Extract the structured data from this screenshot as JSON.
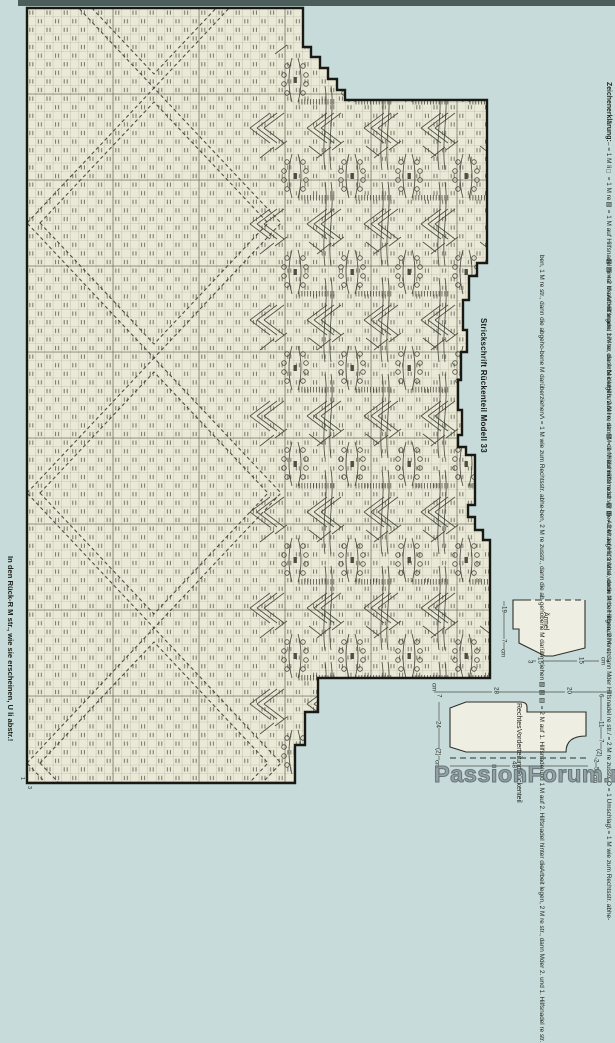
{
  "colors": {
    "page_bg": "#c7dcda",
    "top_band": "#4d5d59",
    "chart_bg": "#eae8d6",
    "grid_thin": "#a0a48f",
    "grid_major": "#656a58",
    "border": "#181815",
    "symbol": "#3c4035",
    "schematic_fill": "#efeee2"
  },
  "legend": {
    "heading": "Zeichenerklärung:",
    "col1_lines": [
      "Zeichenerklärung:",
      "– = 1 M li",
      "□ = 1 M re",
      "▨ = 1 M auf Hilfsnadel hinter die",
      "Arbeit legen, 1 M re, dann M der",
      "Hilfsnadel re str.",
      "▧ = 1 M auf Hilfsnadel vor die",
      "Arbeit legen, 1 M re, dann M der",
      "Hilfsnadel re str."
    ],
    "col2_lines": [
      "▨▨ = 2 M auf Hilfsnadel hin-",
      "ter die Arbeit legen, 2 M re, dann",
      "M der Hilfsnadel re str.",
      "▧▧ = 2 M auf Hilfsnadel vor",
      "die Arbeit legen, 2 M re, dann M",
      "der Hilfsnadel re str.",
      "/ = 2 M re zusstr.",
      "O = 1 Umschlag",
      "\\ = 1 M wie zum Rechtsstr. abhe-"
    ],
    "col3_lines": [
      "ben, 1 M re str., dann die abgeho-",
      "bene M darüberziehen",
      "Λ = 1 M wie zum Rechtsstr. abhe-",
      "ben, 2 M re zusstr., dann die ab-",
      "gehobene M darüberziehen",
      "▨▨▥ = 2 M auf 1. Hilfsnadel",
      "und 1 M auf 2. Hilfsnadel hinter die",
      "Arbeit legen, 2 M re str., dann M",
      "der 2. und 1. Hilfsnadel re str."
    ]
  },
  "chart_title": "Strickschrift Rückenteil Modell 33",
  "footnote": "In den Rück-R M str., wie sie erscheinen, U li abstr.!",
  "corner_marks": [
    {
      "t": "1",
      "x": 19,
      "y": 777
    },
    {
      "t": "3",
      "x": 26,
      "y": 786
    }
  ],
  "watermark": "PassionForum.ru",
  "chart": {
    "cell": 8.6,
    "outline": "M27,8 L303,8 L303,47 L311,47 L311,57 L320,57 L320,68 L328,68 L328,79 L337,79 L337,90 L345,90 L345,100 L487,100 L487,263 L477,263 L477,276 L469,276 L469,300 L463,300 L463,330 L467,330 L467,352 L461,352 L461,380 L458,380 L458,410 L462,410 L462,435 L458,435 L458,447 L466,447 L466,455 L475,455 L475,505 L468,505 L468,517 L475,517 L475,530 L483,530 L483,540 L490,540 L490,678 L318,678 L318,712 L305,712 L305,745 L295,745 L295,783 L27,783 Z",
    "bbox": [
      27,
      8,
      463,
      775
    ],
    "major_xs": [
      113,
      199,
      285,
      371,
      457
    ],
    "major_ys": [
      94,
      180,
      266,
      352,
      438,
      524,
      610,
      696,
      782
    ],
    "diamond_center_x": 154,
    "diamond_center_ys": [
      -47,
      223,
      493,
      763
    ],
    "diamond_rx": 127,
    "diamond_ry": 135,
    "cluster_xs": [
      295,
      352,
      409,
      466
    ],
    "cluster_ys": [
      80,
      176,
      272,
      368,
      464,
      560,
      656,
      752
    ]
  },
  "schematics": {
    "sleeve": {
      "label": "Ärmel",
      "solid_path": "M525,600 L513,600 L513,629 L519,629 L519,643 L545,656 L553,656 L585,648 L585,600",
      "dashed_path": "M525,600 L585,600",
      "dim_lines": [
        [
          504,
          601,
          504,
          655
        ],
        [
          528,
          661,
          609,
          661
        ]
      ],
      "measurements": [
        {
          "t": "19",
          "x": 500,
          "y": 606
        },
        {
          "t": "7",
          "x": 500,
          "y": 639
        },
        {
          "t": "cm",
          "x": 499,
          "y": 649
        },
        {
          "t": "3",
          "x": 526,
          "y": 660
        },
        {
          "t": "15",
          "x": 536,
          "y": 657
        },
        {
          "t": "15",
          "x": 577,
          "y": 657
        },
        {
          "t": "cm",
          "x": 599,
          "y": 657
        }
      ]
    },
    "body": {
      "label_lines": [
        "Rechtes",
        "Vorderteil",
        "und",
        "Rückenteil"
      ],
      "solid_path": "M450,708 L466,702 L520,702 Q527,702 527,707 L527,712 L586,712 L586,736 Q566,736 566,752 L466,752 L450,747 Z",
      "dashed_path": "M450,758 L588,758",
      "dim_lines": [
        [
          434,
          692,
          612,
          692
        ],
        [
          439,
          702,
          439,
          777
        ],
        [
          601,
          695,
          601,
          756
        ],
        [
          450,
          766,
          588,
          766
        ],
        [
          596,
          756,
          596,
          780
        ]
      ],
      "measurements": [
        {
          "t": "cm",
          "x": 430,
          "y": 683
        },
        {
          "t": "7",
          "x": 435,
          "y": 694
        },
        {
          "t": "28",
          "x": 492,
          "y": 687
        },
        {
          "t": "20",
          "x": 565,
          "y": 687
        },
        {
          "t": "6",
          "x": 597,
          "y": 694
        },
        {
          "t": "11",
          "x": 597,
          "y": 721
        },
        {
          "t": "7",
          "x": 597,
          "y": 739
        },
        {
          "t": "(2)",
          "x": 595,
          "y": 749
        },
        {
          "t": "2",
          "x": 592,
          "y": 759
        },
        {
          "t": "5",
          "x": 592,
          "y": 767
        },
        {
          "t": "cm",
          "x": 591,
          "y": 775
        },
        {
          "t": "24",
          "x": 434,
          "y": 721
        },
        {
          "t": "(2)",
          "x": 434,
          "y": 748
        },
        {
          "t": "cm",
          "x": 433,
          "y": 760
        },
        {
          "t": "48",
          "x": 510,
          "y": 761
        }
      ]
    }
  }
}
